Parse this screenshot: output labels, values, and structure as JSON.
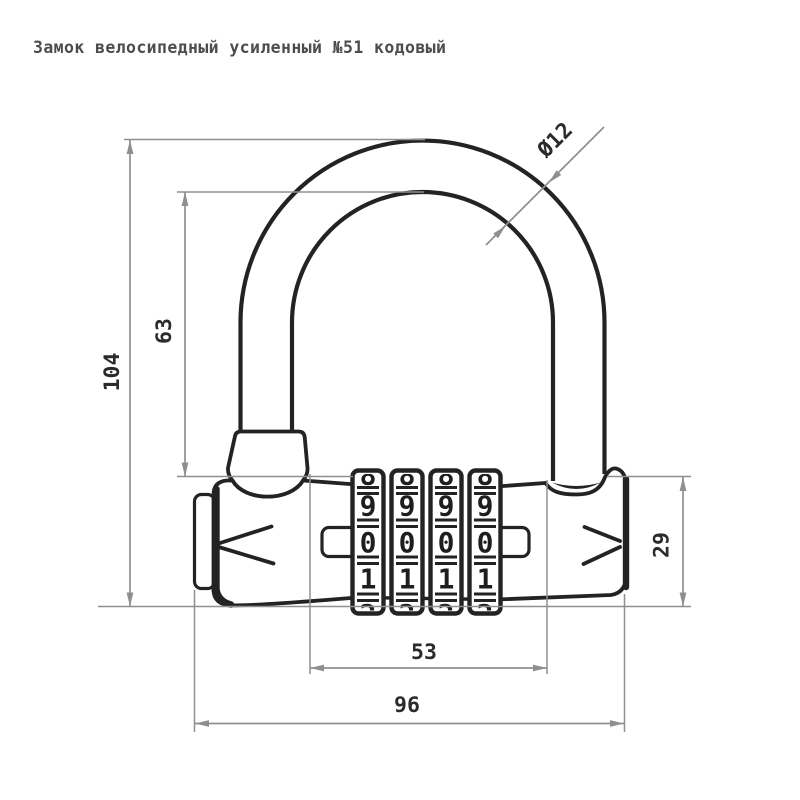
{
  "title": "Замок велосипедный усиленный №51 кодовый",
  "dimensions": {
    "total_height_mm": "104",
    "shackle_clear_height_mm": "63",
    "body_height_mm": "29",
    "dial_block_width_mm": "53",
    "total_width_mm": "96",
    "shackle_diameter": "Ø12"
  },
  "dials": {
    "count": 4,
    "partial_top_digit": "8",
    "partial_bottom_digit": "2",
    "columns": [
      {
        "digits": [
          "9",
          "0",
          "1"
        ]
      },
      {
        "digits": [
          "9",
          "0",
          "1"
        ]
      },
      {
        "digits": [
          "9",
          "0",
          "1"
        ]
      },
      {
        "digits": [
          "9",
          "0",
          "1"
        ]
      }
    ]
  },
  "colors": {
    "background": "#ffffff",
    "drawing_line": "#232323",
    "dimension_line": "#8f8f8f",
    "dimension_text": "#2b2b2b",
    "title_text": "#4d4d4d"
  }
}
